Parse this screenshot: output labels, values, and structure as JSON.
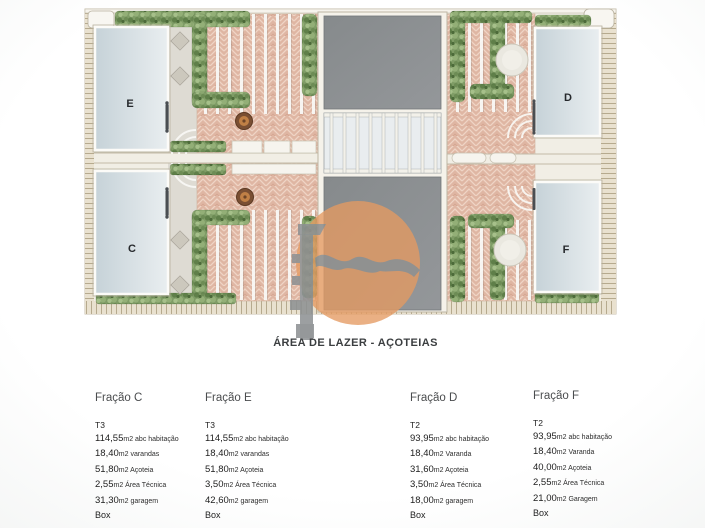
{
  "title": "ÁREA DE LAZER - AÇOTEIAS",
  "plan": {
    "unit_labels": {
      "e": "E",
      "c": "C",
      "d": "D",
      "f": "F"
    },
    "colors": {
      "tile": "#dfb6a3",
      "skylight": "#d4dee2",
      "roof": "#8b8e8f",
      "foliage": "#7f9c66",
      "paving": "#dedbd3",
      "watermark_orange": "#e49a62",
      "watermark_gray": "#8d9092"
    }
  },
  "fractions": [
    {
      "name": "Fração C",
      "type": "T3",
      "lines": [
        {
          "num": "114,55",
          "rest": "m2 abc habitação"
        },
        {
          "num": "18,40",
          "rest": "m2 varandas"
        },
        {
          "num": "51,80",
          "rest": "m2 Açoteia"
        },
        {
          "num": "2,55",
          "rest": "m2 Área Técnica"
        },
        {
          "num": "31,30",
          "rest": "m2 garagem"
        }
      ],
      "box": "Box"
    },
    {
      "name": "Fração E",
      "type": "T3",
      "lines": [
        {
          "num": "114,55",
          "rest": "m2 abc habitação"
        },
        {
          "num": "18,40",
          "rest": "m2 varandas"
        },
        {
          "num": "51,80",
          "rest": "m2 Açoteia"
        },
        {
          "num": "3,50",
          "rest": "m2 Área Técnica"
        },
        {
          "num": "42,60",
          "rest": "m2 garagem"
        }
      ],
      "box": "Box"
    },
    {
      "name": "Fração D",
      "type": "T2",
      "lines": [
        {
          "num": "93,95",
          "rest": "m2 abc habitação"
        },
        {
          "num": "18,40",
          "rest": "m2 Varanda"
        },
        {
          "num": "31,60",
          "rest": "m2 Açoteia"
        },
        {
          "num": "3,50",
          "rest": "m2 Área Técnica"
        },
        {
          "num": "18,00",
          "rest": "m2 garagem"
        }
      ],
      "box": "Box"
    },
    {
      "name": "Fração F",
      "type": "T2",
      "lines": [
        {
          "num": "93,95",
          "rest": "m2 abc habitação"
        },
        {
          "num": "18,40",
          "rest": "m2 Varanda"
        },
        {
          "num": "40,00",
          "rest": "m2 Açoteia"
        },
        {
          "num": "2,55",
          "rest": "m2 Área Técnica"
        },
        {
          "num": "21,00",
          "rest": "m2 Garagem"
        }
      ],
      "box": "Box"
    }
  ]
}
